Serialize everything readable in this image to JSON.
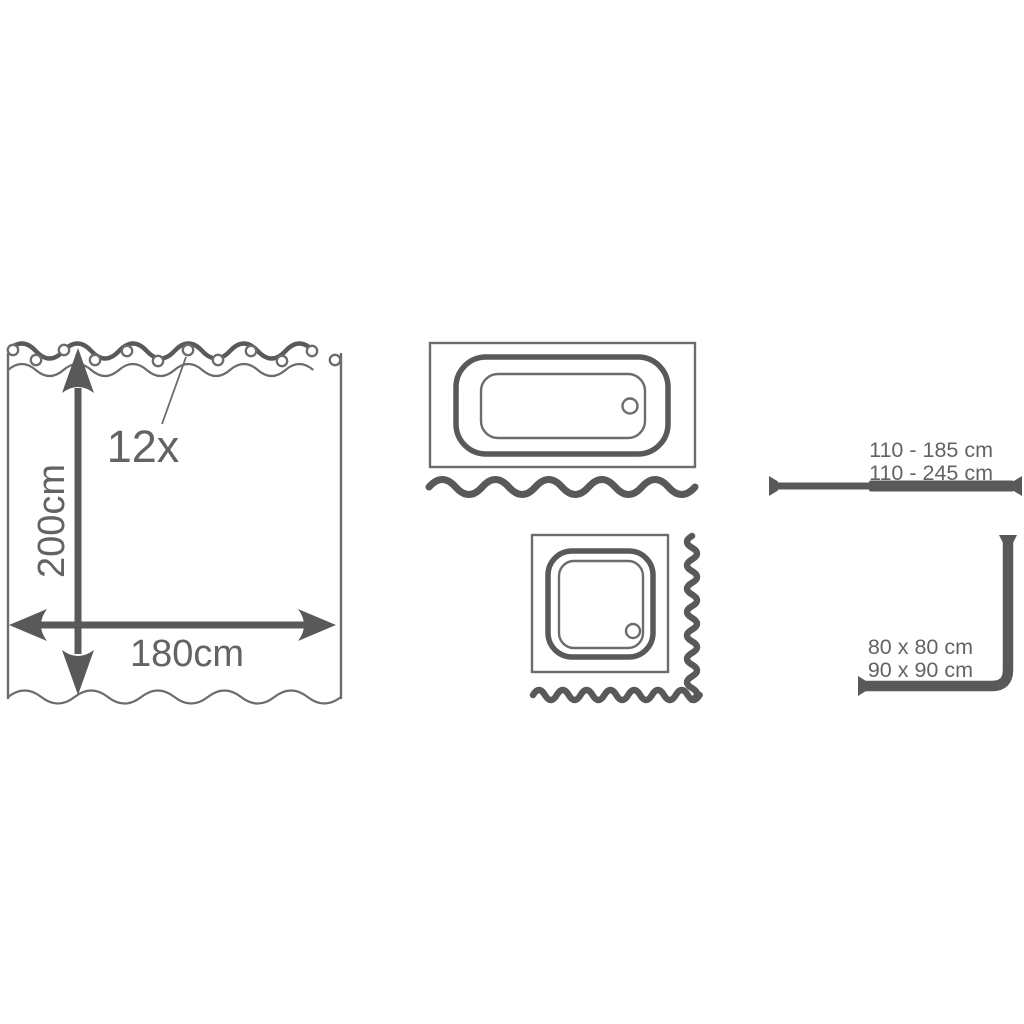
{
  "colors": {
    "dark": "#58595b",
    "line": "#6b6c6e",
    "text": "#626365"
  },
  "curtain": {
    "rings_label": "12x",
    "ring_count": 12,
    "height_label": "200cm",
    "width_label": "180cm"
  },
  "straight_rod": {
    "length_range_1": "110 - 185 cm",
    "length_range_2": "110 - 245 cm"
  },
  "corner_rod": {
    "size_option_1": "80 x 80 cm",
    "size_option_2": "90 x 90 cm"
  }
}
